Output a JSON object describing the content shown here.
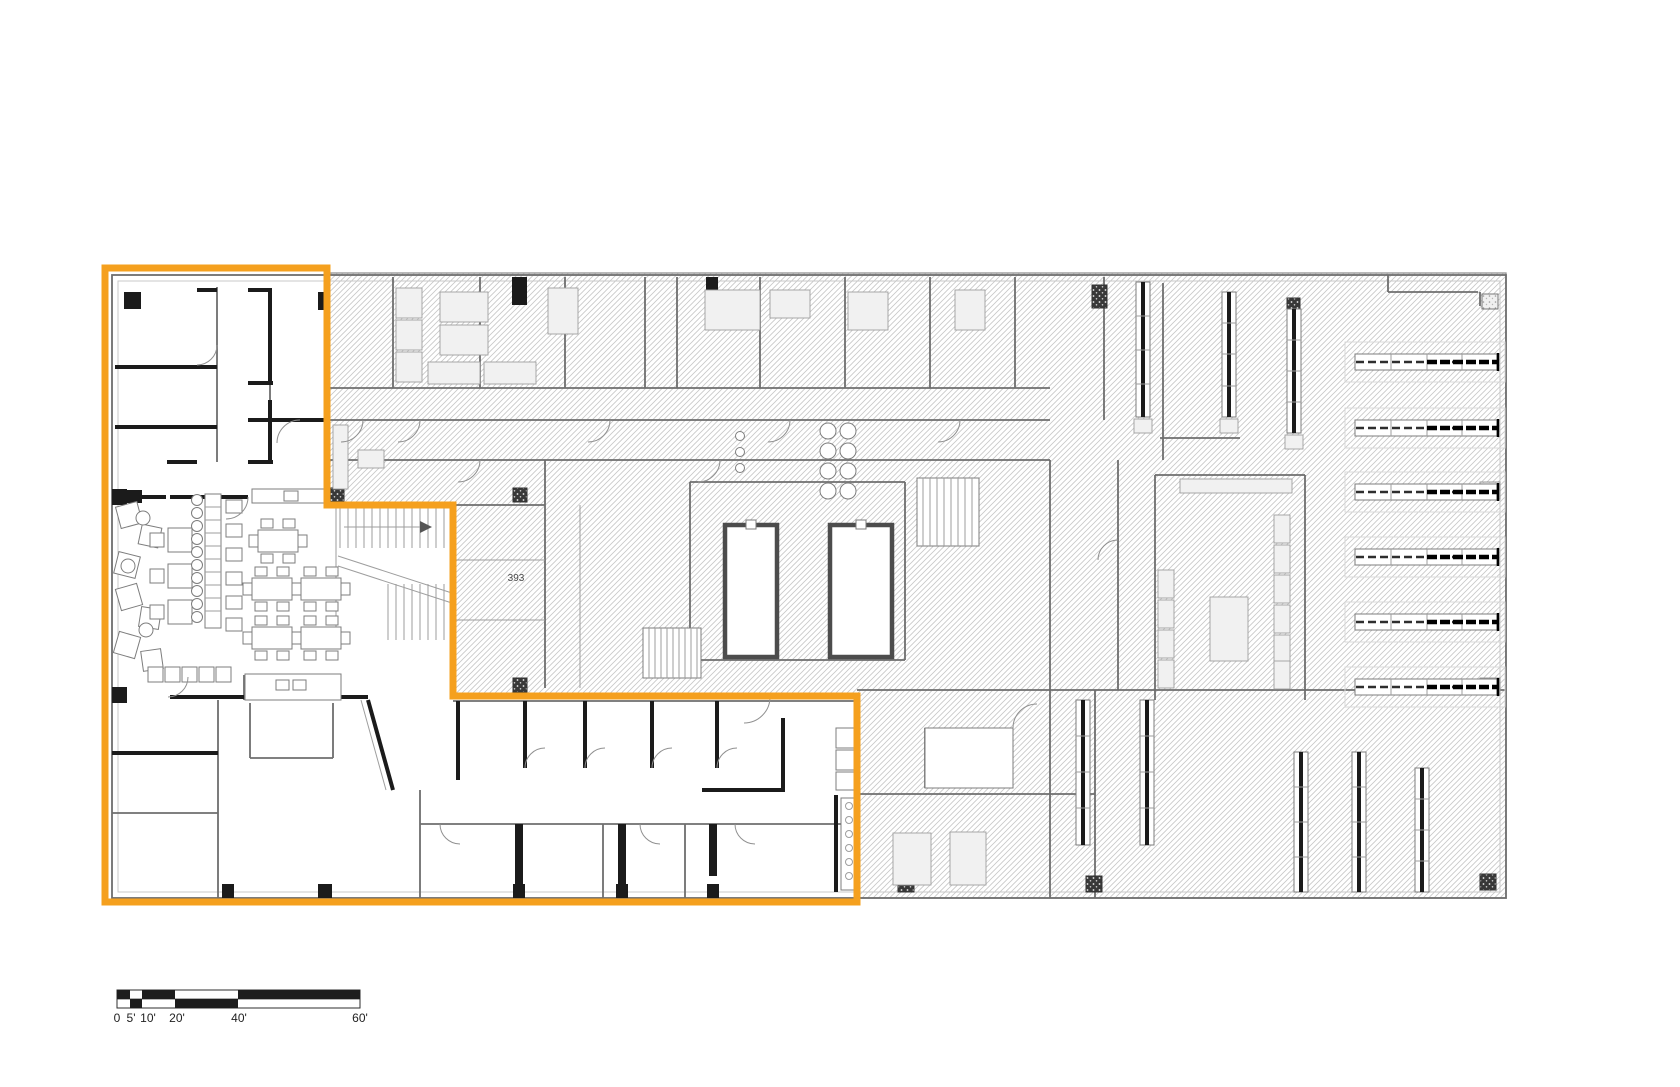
{
  "plan": {
    "room_label": "393",
    "colors": {
      "highlight": "#F5A01E",
      "wall": "#1b1b1b",
      "hatch": "#c7c7c7",
      "detail": "#8f8f8f"
    },
    "scale_bar": {
      "labels": [
        "0",
        "5'",
        "10'",
        "20'",
        "40'",
        "60'"
      ]
    }
  }
}
